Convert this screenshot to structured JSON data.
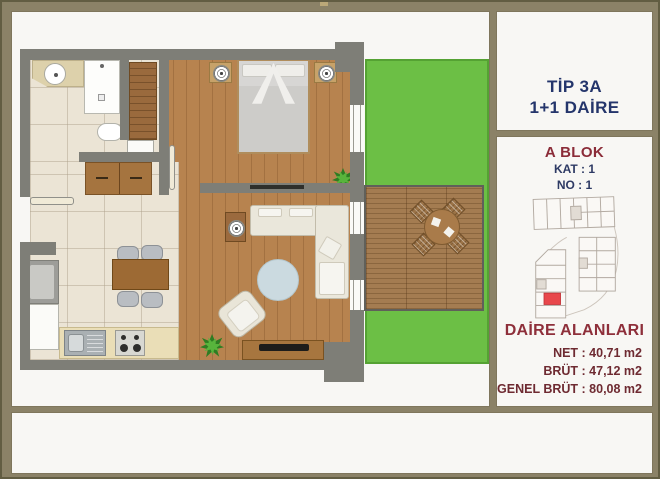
{
  "right_panel": {
    "type_box": {
      "line1": "TİP 3A",
      "line2": "1+1 DAİRE"
    },
    "block_box": {
      "title": "A BLOK",
      "kat": "KAT : 1",
      "no": "NO : 1"
    },
    "areas_box": {
      "title": "DAİRE ALANLARI",
      "rows": [
        "NET : 40,71 m2",
        "BRÜT : 47,12 m2",
        "GENEL BRÜT : 80,08 m2"
      ]
    }
  },
  "site_plan": {
    "highlight_unit_color": "#e8474b",
    "outline_color": "#b2a9a0"
  },
  "colors": {
    "frame_khaki": "#8b8267",
    "panel_bg": "#f8f7f4",
    "title_navy": "#24356b",
    "title_maroon": "#8b2c38",
    "areas_maroon": "#6e2a31",
    "wall_gray": "#7e7e77",
    "wood_floor": "#b7834f",
    "tile_floor": "#ebe4d5",
    "lawn_green": "#6cbf45",
    "deck_wood": "#a47c51"
  }
}
